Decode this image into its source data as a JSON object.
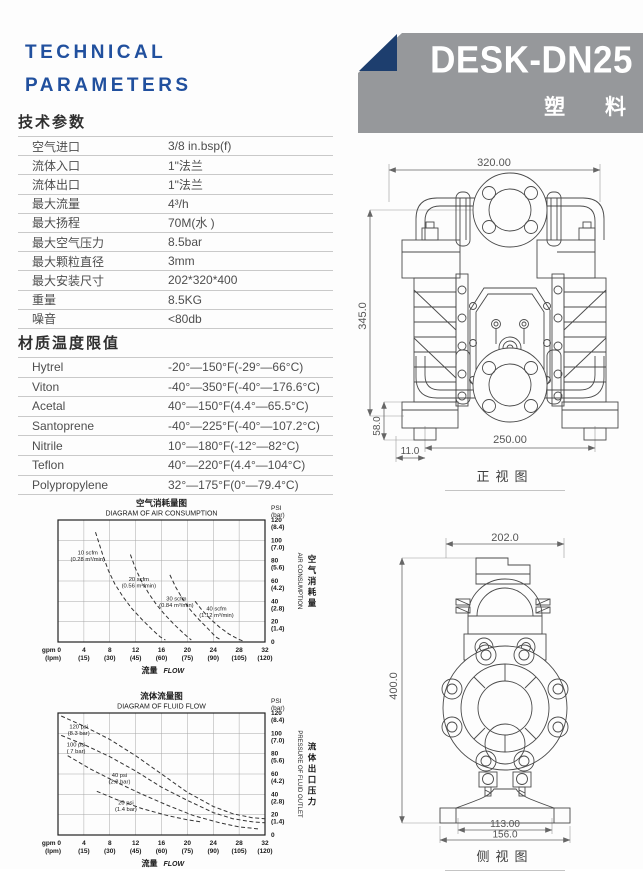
{
  "header": {
    "title_line1": "TECHNICAL",
    "title_line2": "PARAMETERS",
    "model": "DESK-DN25",
    "material": "塑 料"
  },
  "colors": {
    "accent_blue": "#21509e",
    "banner_gray": "#96989b",
    "triangle_navy": "#1d3e6e"
  },
  "tech_table": {
    "heading": "技术参数",
    "rows": [
      {
        "label": "空气进口",
        "value": "3/8 in.bsp(f)"
      },
      {
        "label": "流体入口",
        "value": "1\"法兰"
      },
      {
        "label": "流体出口",
        "value": "1\"法兰"
      },
      {
        "label": "最大流量",
        "value": "4³/h"
      },
      {
        "label": "最大扬程",
        "value": "70M(水 )"
      },
      {
        "label": "最大空气压力",
        "value": "8.5bar"
      },
      {
        "label": "最大颗粒直径",
        "value": "3mm"
      },
      {
        "label": "最大安装尺寸",
        "value": "202*320*400"
      },
      {
        "label": "重量",
        "value": "8.5KG"
      },
      {
        "label": "噪音",
        "value": "<80db"
      }
    ]
  },
  "material_table": {
    "heading": "材质温度限值",
    "rows": [
      {
        "label": "Hytrel",
        "value": "-20°—150°F(-29°—66°C)"
      },
      {
        "label": "Viton",
        "value": "-40°—350°F(-40°—176.6°C)"
      },
      {
        "label": "Acetal",
        "value": "40°—150°F(4.4°—65.5°C)"
      },
      {
        "label": "Santoprene",
        "value": "-40°—225°F(-40°—107.2°C)"
      },
      {
        "label": "Nitrile",
        "value": "10°—180°F(-12°—82°C)"
      },
      {
        "label": "Teflon",
        "value": "40°—220°F(4.4°—104°C)"
      },
      {
        "label": "Polypropylene",
        "value": "32°—175°F(0°—79.4°C)"
      }
    ]
  },
  "chart_data": [
    {
      "type": "line",
      "title_cn": "空气消耗量图",
      "title_en": "DIAGRAM OF AIR CONSUMPTION",
      "xlabel_cn": "流量",
      "xlabel_en": "FLOW",
      "y_axis_unit_1": "PSI",
      "y_axis_unit_2": "(bar)",
      "right_label_en": "AIR CONSUMPTION",
      "right_label_cn": "空气消耗量",
      "xlim": [
        0,
        32
      ],
      "ylim": [
        0,
        120
      ],
      "x_step": 4,
      "y_step": 20,
      "grid": true,
      "x_ticks": [
        {
          "v": 0,
          "top": "gpm 0",
          "bottom": "(lpm)"
        },
        {
          "v": 4,
          "top": "4",
          "bottom": "(15)"
        },
        {
          "v": 8,
          "top": "8",
          "bottom": "(30)"
        },
        {
          "v": 12,
          "top": "12",
          "bottom": "(45)"
        },
        {
          "v": 16,
          "top": "16",
          "bottom": "(60)"
        },
        {
          "v": 20,
          "top": "20",
          "bottom": "(75)"
        },
        {
          "v": 24,
          "top": "24",
          "bottom": "(90)"
        },
        {
          "v": 28,
          "top": "28",
          "bottom": "(105)"
        },
        {
          "v": 32,
          "top": "32",
          "bottom": "(120)"
        }
      ],
      "y_ticks": [
        {
          "v": 120,
          "psi": "120",
          "bar": "(8.4)"
        },
        {
          "v": 100,
          "psi": "100",
          "bar": "(7.0)"
        },
        {
          "v": 80,
          "psi": "80",
          "bar": "(5.6)"
        },
        {
          "v": 60,
          "psi": "60",
          "bar": "(4.2)"
        },
        {
          "v": 40,
          "psi": "40",
          "bar": "(2.8)"
        },
        {
          "v": 20,
          "psi": "20",
          "bar": "(1.4)"
        },
        {
          "v": 0,
          "psi": "0",
          "bar": ""
        }
      ],
      "series": [
        {
          "label": "10 scfm",
          "label2": "(0.28 m³/min)",
          "label_at": [
            4.6,
            86
          ],
          "points": [
            [
              5.8,
              108
            ],
            [
              6.4,
              96
            ],
            [
              7.0,
              84
            ],
            [
              7.8,
              70
            ],
            [
              8.8,
              57
            ],
            [
              10.0,
              45
            ],
            [
              11.4,
              33
            ],
            [
              13.0,
              22
            ],
            [
              14.6,
              12
            ],
            [
              15.8,
              5
            ],
            [
              16.6,
              2
            ]
          ]
        },
        {
          "label": "20 scfm",
          "label2": "(0.56 m³/min)",
          "label_at": [
            12.5,
            60
          ],
          "points": [
            [
              11.2,
              86
            ],
            [
              12.0,
              72
            ],
            [
              12.9,
              60
            ],
            [
              14.0,
              48
            ],
            [
              15.2,
              37
            ],
            [
              16.5,
              27
            ],
            [
              18.0,
              17
            ],
            [
              19.5,
              8
            ],
            [
              20.6,
              2
            ]
          ]
        },
        {
          "label": "30 scfm",
          "label2": "(0.84 m³/min)",
          "label_at": [
            18.3,
            41
          ],
          "points": [
            [
              17.3,
              66
            ],
            [
              18.2,
              54
            ],
            [
              19.2,
              43
            ],
            [
              20.4,
              32
            ],
            [
              21.8,
              22
            ],
            [
              23.2,
              13
            ],
            [
              24.4,
              5
            ],
            [
              25.2,
              2
            ]
          ]
        },
        {
          "label": "40 scfm",
          "label2": "(1.12 m³/min)",
          "label_at": [
            24.5,
            31
          ],
          "points": [
            [
              21.2,
              40
            ],
            [
              22.3,
              31
            ],
            [
              23.5,
              23
            ],
            [
              24.9,
              15
            ],
            [
              26.4,
              8
            ],
            [
              27.8,
              3
            ],
            [
              28.6,
              1
            ]
          ]
        }
      ]
    },
    {
      "type": "line",
      "title_cn": "流体流量图",
      "title_en": "DIAGRAM OF FLUID FLOW",
      "xlabel_cn": "流量",
      "xlabel_en": "FLOW",
      "y_axis_unit_1": "PSI",
      "y_axis_unit_2": "(bar)",
      "right_label_en": "PRESSURE OF FLUID OUTLET",
      "right_label_cn": "流体出口压力",
      "xlim": [
        0,
        32
      ],
      "ylim": [
        0,
        120
      ],
      "x_step": 4,
      "y_step": 20,
      "grid": true,
      "x_ticks": [
        {
          "v": 0,
          "top": "gpm 0",
          "bottom": "(lpm)"
        },
        {
          "v": 4,
          "top": "4",
          "bottom": "(15)"
        },
        {
          "v": 8,
          "top": "8",
          "bottom": "(30)"
        },
        {
          "v": 12,
          "top": "12",
          "bottom": "(45)"
        },
        {
          "v": 16,
          "top": "16",
          "bottom": "(60)"
        },
        {
          "v": 20,
          "top": "20",
          "bottom": "(75)"
        },
        {
          "v": 24,
          "top": "24",
          "bottom": "(90)"
        },
        {
          "v": 28,
          "top": "28",
          "bottom": "(105)"
        },
        {
          "v": 32,
          "top": "32",
          "bottom": "(120)"
        }
      ],
      "y_ticks": [
        {
          "v": 120,
          "psi": "120",
          "bar": "(8.4)"
        },
        {
          "v": 100,
          "psi": "100",
          "bar": "(7.0)"
        },
        {
          "v": 80,
          "psi": "80",
          "bar": "(5.6)"
        },
        {
          "v": 60,
          "psi": "60",
          "bar": "(4.2)"
        },
        {
          "v": 40,
          "psi": "40",
          "bar": "(2.8)"
        },
        {
          "v": 20,
          "psi": "20",
          "bar": "(1.4)"
        },
        {
          "v": 0,
          "psi": "0",
          "bar": ""
        }
      ],
      "series": [
        {
          "label": "120 psi",
          "label2": "(8.3 bar)",
          "label_at": [
            3.2,
            105
          ],
          "points": [
            [
              0.5,
              117
            ],
            [
              4,
              107
            ],
            [
              8,
              94
            ],
            [
              12,
              78
            ],
            [
              16,
              60
            ],
            [
              20,
              42
            ],
            [
              24,
              28
            ],
            [
              27,
              21
            ],
            [
              30,
              17
            ],
            [
              32,
              16
            ]
          ]
        },
        {
          "label": "100 psi",
          "label2": "( 7 bar)",
          "label_at": [
            2.8,
            87
          ],
          "points": [
            [
              0.5,
              98
            ],
            [
              4,
              89
            ],
            [
              8,
              77
            ],
            [
              12,
              63
            ],
            [
              16,
              47
            ],
            [
              20,
              34
            ],
            [
              24,
              22
            ],
            [
              27,
              16
            ],
            [
              30,
              13
            ],
            [
              32,
              12
            ]
          ]
        },
        {
          "label": "40 psi",
          "label2": "(2.8 bar)",
          "label_at": [
            9.5,
            57
          ],
          "points": [
            [
              1.5,
              78
            ],
            [
              5,
              65
            ],
            [
              9,
              52
            ],
            [
              13,
              40
            ],
            [
              17,
              29
            ],
            [
              21,
              19
            ],
            [
              25,
              12
            ],
            [
              28,
              8
            ],
            [
              31,
              6
            ]
          ]
        },
        {
          "label": "20 psi",
          "label2": "(1.4 bar)",
          "label_at": [
            10.5,
            30
          ],
          "points": [
            [
              6,
              43
            ],
            [
              9,
              35
            ],
            [
              13,
              26
            ],
            [
              17,
              19
            ],
            [
              20,
              15
            ],
            [
              22,
              13
            ]
          ]
        }
      ]
    }
  ],
  "drawings": {
    "front": {
      "caption": "正视图",
      "width_label": "320.00",
      "height_label": "345.0",
      "bolt_span_label": "250.00",
      "base_height_label": "58.0",
      "foot_offset_label": "11.0"
    },
    "side": {
      "caption": "侧视图",
      "width_label": "202.0",
      "height_label": "400.0",
      "port_span_label": "113.00",
      "base_width_label": "156.0"
    }
  }
}
